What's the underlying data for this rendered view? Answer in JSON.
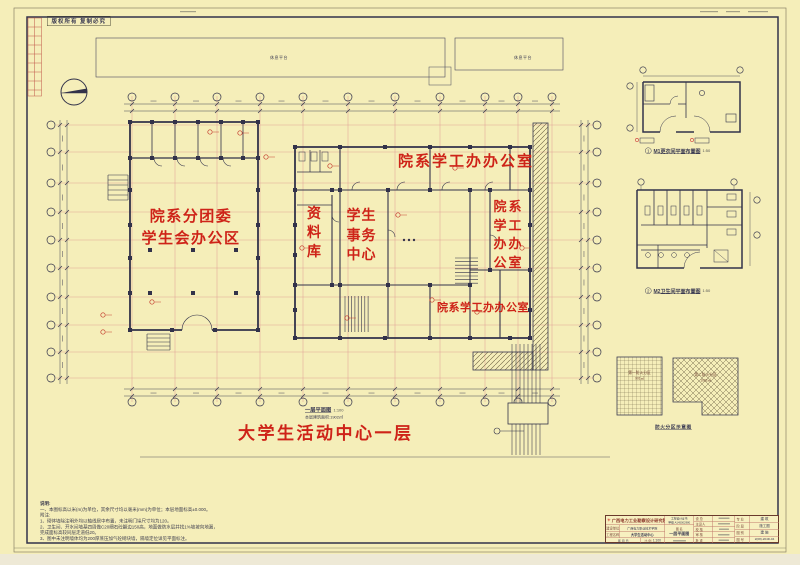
{
  "colors": {
    "paper": "#f5eeb9",
    "ink": "#3a3a52",
    "red": "#ce2318",
    "axis_pink": "#e2a498",
    "table_red": "#c07a6c"
  },
  "stamp": {
    "copyright": "版权所有 复制必究"
  },
  "plan": {
    "platform_left": "休息平台",
    "platform_right": "休息平台",
    "rooms": {
      "top_office": "院系学工办办公室",
      "league_line1": "院系分团委",
      "league_line2": "学生会办公区",
      "archive": "资料库",
      "affairs": "学生事务中心",
      "right_office": "院系学工办办公室",
      "bottom_office": "院系学工办办公室"
    },
    "caption": "一层平面图",
    "caption_scale": "1:100",
    "caption_area": "本层建筑面积:1902㎡",
    "main_title": "大学生活动中心一层"
  },
  "details": [
    {
      "num": "1",
      "label": "M1更衣间平面布置图",
      "scale": "1:50"
    },
    {
      "num": "2",
      "label": "M2卫生间平面布置图",
      "scale": "1:50"
    }
  ],
  "fire": {
    "title": "防火分区示意图",
    "zones": [
      {
        "name": "第一防火分区",
        "area": "901㎡"
      },
      {
        "name": "第二防火分区",
        "area": "1002㎡"
      }
    ]
  },
  "notes": {
    "title": "说明:",
    "lines": [
      "一、本图标高以米(m)为单位，其余尺寸均以毫米(mm)为单位；本层地面标高±0.000。",
      "附注:",
      "1、砌体墙除注明外均以轴线居中布置，未注明门垛尺寸均为120。",
      "2、卫生间、开水间墙基四周做C20细石砼翻边150高，地面做防水层并找1%坡坡向地漏，",
      "      完成面标高较同层走道低20。",
      "3、图中未注明墙体均为200厚蒸压加气砼砌块墙，隔墙定位详见平面标注。"
    ]
  },
  "titleblock": {
    "company": "广西电力工业勘察设计研究院",
    "logo_glyph": "✳",
    "cert_line1": "工程设计证书",
    "cert_line2": "甲级 A145002980",
    "owner_label": "建设单位",
    "owner_value": "广西电力职业技术学院",
    "project_label": "工程名称",
    "project_value": "大学生活动中心",
    "drawing_label": "图 名",
    "drawing_value": "一层平面图",
    "date_text": "年    月    日",
    "scale_label": "比 例",
    "scale_value": "1:100",
    "roles": [
      {
        "label": "设 总"
      },
      {
        "label": "主设人"
      },
      {
        "label": "校 核"
      },
      {
        "label": "审 核"
      },
      {
        "label": "批 准"
      }
    ],
    "spec_label": "专 业",
    "spec_value": "建 筑",
    "stage_label": "阶 段",
    "stage_value": "施工图",
    "cat_label": "图 别",
    "cat_value": "建 施",
    "no_label": "图 号",
    "no_value": "2(08)-204D-04"
  }
}
